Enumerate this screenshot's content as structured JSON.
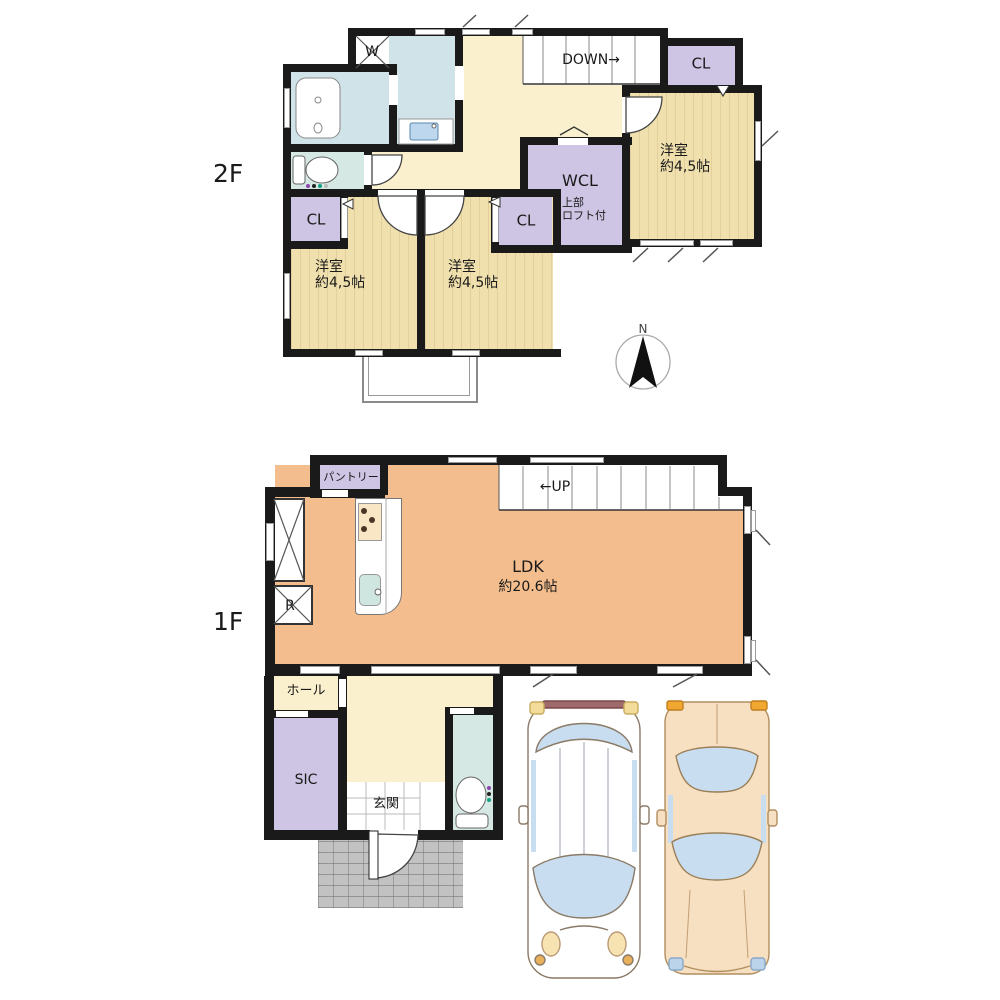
{
  "floor_plan": {
    "second_floor": {
      "floor_label": "2F",
      "stairs_label": "DOWN→",
      "washer_label": "W",
      "closet_label": "CL",
      "wcl": {
        "label": "WCL",
        "note_line1": "上部",
        "note_line2": "ロフト付"
      },
      "bedrooms": [
        {
          "name": "洋室",
          "size": "約4,5帖"
        },
        {
          "name": "洋室",
          "size": "約4,5帖"
        },
        {
          "name": "洋室",
          "size": "約4,5帖"
        }
      ],
      "compass_label": "N"
    },
    "first_floor": {
      "floor_label": "1F",
      "stairs_label": "←UP",
      "pantry_label": "パントリー",
      "ldk": {
        "name": "LDK",
        "size": "約20.6帖"
      },
      "refrigerator_label": "R",
      "hall_label": "ホール",
      "sic_label": "SIC",
      "entrance_label": "玄関"
    }
  },
  "colors": {
    "wall": "#1a1a1a",
    "cream": "#faf0cd",
    "wood": "#f0e0ae",
    "closet": "#cdc5e3",
    "bath": "#cfe3e8",
    "wc": "#d6e8e4",
    "ldk": "#f4bd8d",
    "stone": "#c2c2c2",
    "glass": "#c9ddf0",
    "car_beige": "#f7dfc2"
  }
}
